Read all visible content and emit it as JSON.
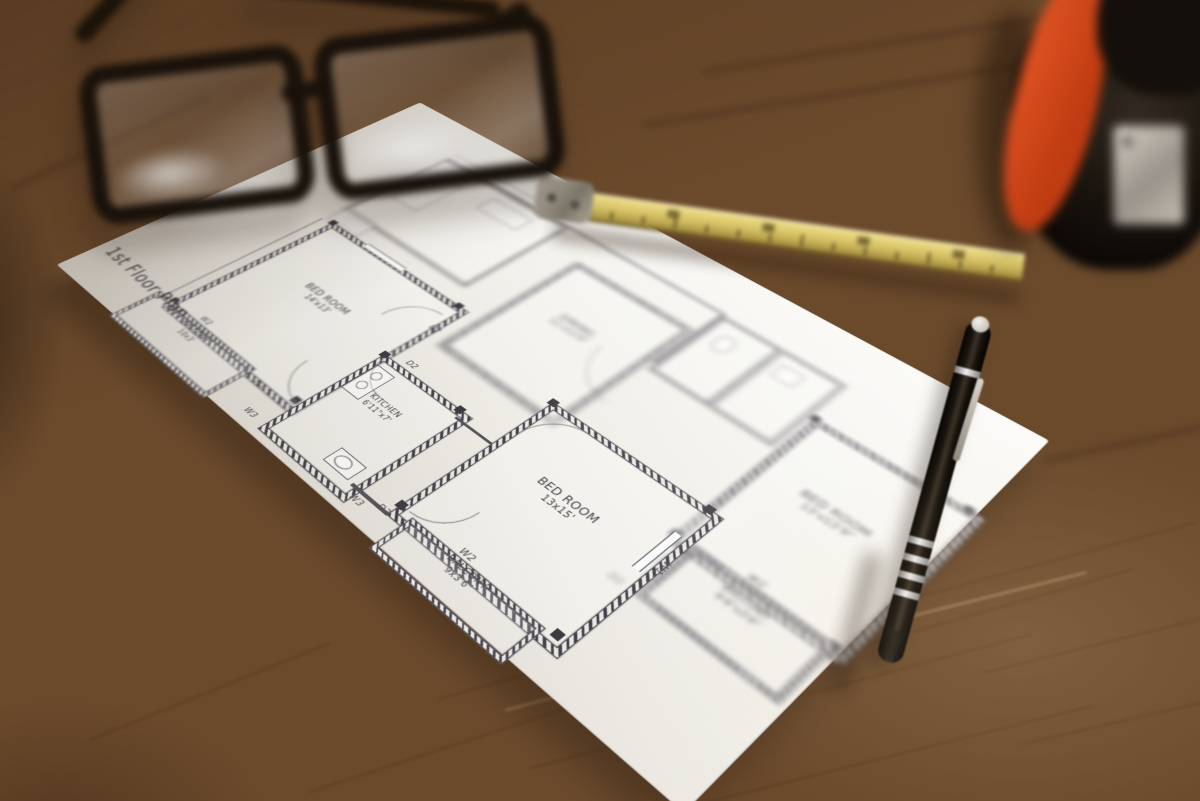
{
  "scene": {
    "objects": [
      "eyeglasses",
      "floor-plan-sheet",
      "folding-ruler",
      "pen",
      "tape-measure",
      "wooden-table"
    ],
    "colors": {
      "wood_light": "#c8a173",
      "wood_mid": "#a87c50",
      "wood_dark": "#7b5531",
      "paper": "#f2f0ea",
      "ink": "#44414b",
      "ruler_yellow": "#d2bc5f",
      "tape_orange": "#d94f24",
      "pen_black": "#14100b",
      "frame_black": "#17110b"
    }
  },
  "plan": {
    "title": "1st Floor Plan",
    "rooms": [
      {
        "id": "bedroom-1",
        "name": "BED ROOM",
        "size": "14'x13'"
      },
      {
        "id": "balcony-1",
        "name": "BALCONY",
        "size": "10x3'"
      },
      {
        "id": "kitchen",
        "name": "KITCHEN",
        "size": "6'11\"x7'"
      },
      {
        "id": "bedroom-2",
        "name": "BED ROOM",
        "size": "13x15'"
      },
      {
        "id": "balcony-2",
        "name": "BALCONY",
        "size": "9x3'6\""
      },
      {
        "id": "bedroom-3",
        "name": "BED ROOM",
        "size": "13'x13'9\""
      },
      {
        "id": "balcony-3",
        "name": "BALCONY",
        "size": "9'6\"x3'6\""
      },
      {
        "id": "dining",
        "name": "DINING",
        "size": "11'x12'6\""
      }
    ],
    "marks": {
      "w1": "W1",
      "w2": "W2",
      "w3": "W3",
      "d2": "D2",
      "d3": "D3"
    }
  }
}
